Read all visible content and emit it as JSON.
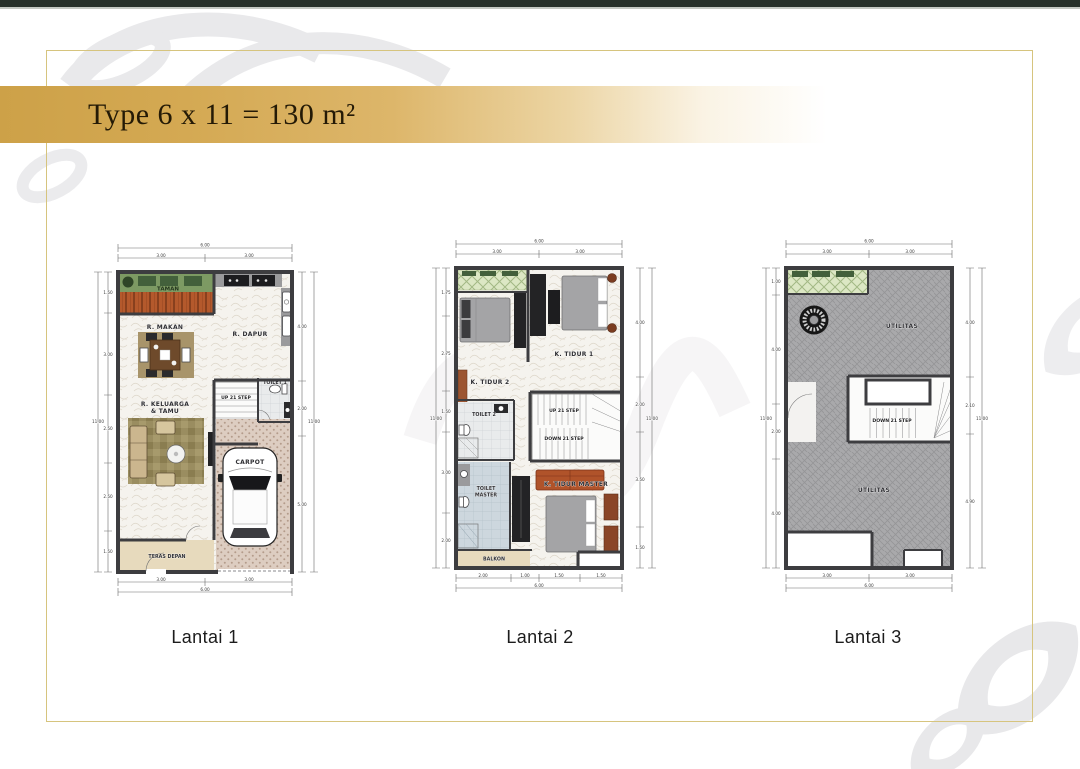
{
  "banner": {
    "title": "Type 6 x 11 = 130 m²"
  },
  "plans": [
    {
      "caption": "Lantai 1",
      "rooms": {
        "taman": "TAMAN",
        "makan": "R. MAKAN",
        "dapur": "R. DAPUR",
        "toilet": "TOILET 1",
        "up": "UP 21 STEP",
        "down": "DOWN 21 STEP",
        "keluarga_1": "R. KELUARGA",
        "keluarga_2": "& TAMU",
        "carpot": "CARPOT",
        "teras": "TERAS DEPAN"
      },
      "dims": {
        "top_total": "6.00",
        "top": [
          "3.00",
          "3.00"
        ],
        "bottom": [
          "3.00",
          "3.00"
        ],
        "bottom_total": "6.00",
        "left_total": "11.00",
        "left": [
          "1.50",
          "3.00",
          "2.50",
          "2.50",
          "1.50"
        ],
        "right": [
          "4.00",
          "2.00",
          "5.00"
        ],
        "right_total": "11.00"
      }
    },
    {
      "caption": "Lantai 2",
      "rooms": {
        "tidur2": "K. TIDUR 2",
        "tidur1": "K. TIDUR 1",
        "toilet2": "TOILET 2",
        "up": "UP 21 STEP",
        "down": "DOWN 21 STEP",
        "toiletm_1": "TOILET",
        "toiletm_2": "MASTER",
        "tidurm": "K. TIDUR MASTER",
        "balkon": "BALKON"
      },
      "dims": {
        "top_total": "6.00",
        "top": [
          "3.00",
          "3.00"
        ],
        "bottom": [
          "2.00",
          "1.00",
          "1.50",
          "1.50"
        ],
        "bottom_total": "6.00",
        "left_total": "11.00",
        "left": [
          "1.75",
          "2.75",
          "1.50",
          "3.00",
          "2.00"
        ],
        "right": [
          "4.00",
          "2.00",
          "3.50",
          "1.50"
        ],
        "right_total": "11.00"
      }
    },
    {
      "caption": "Lantai 3",
      "rooms": {
        "utilitas_a": "UTILITAS",
        "down": "DOWN 21 STEP",
        "utilitas_b": "UTILITAS"
      },
      "dims": {
        "top_total": "6.00",
        "top": [
          "3.00",
          "3.00"
        ],
        "bottom": [
          "3.00",
          "3.00"
        ],
        "bottom_total": "6.00",
        "left_total": "11.00",
        "left": [
          "1.00",
          "4.00",
          "2.00",
          "4.00"
        ],
        "right": [
          "4.00",
          "2.10",
          "4.90"
        ],
        "right_total": "11.00"
      }
    }
  ],
  "colors": {
    "banner_gold": "#d2a54b",
    "frame_gold": "#d6c47e",
    "top_strip": "#27302a",
    "wall": "#3d3d40",
    "taman_green": "#7d9a63",
    "deck_orange": "#b4592c",
    "lattice_green": "#dce7c4",
    "utilitas_gray": "#a9a9ab",
    "tile_blue": "#cdd7de",
    "terrace_beige": "#e7dabd",
    "sofa_tan": "#cbb68e",
    "sofa_orange": "#b0532a",
    "furniture_dark": "#232325",
    "watermark_gray": "#e9e9eb"
  }
}
